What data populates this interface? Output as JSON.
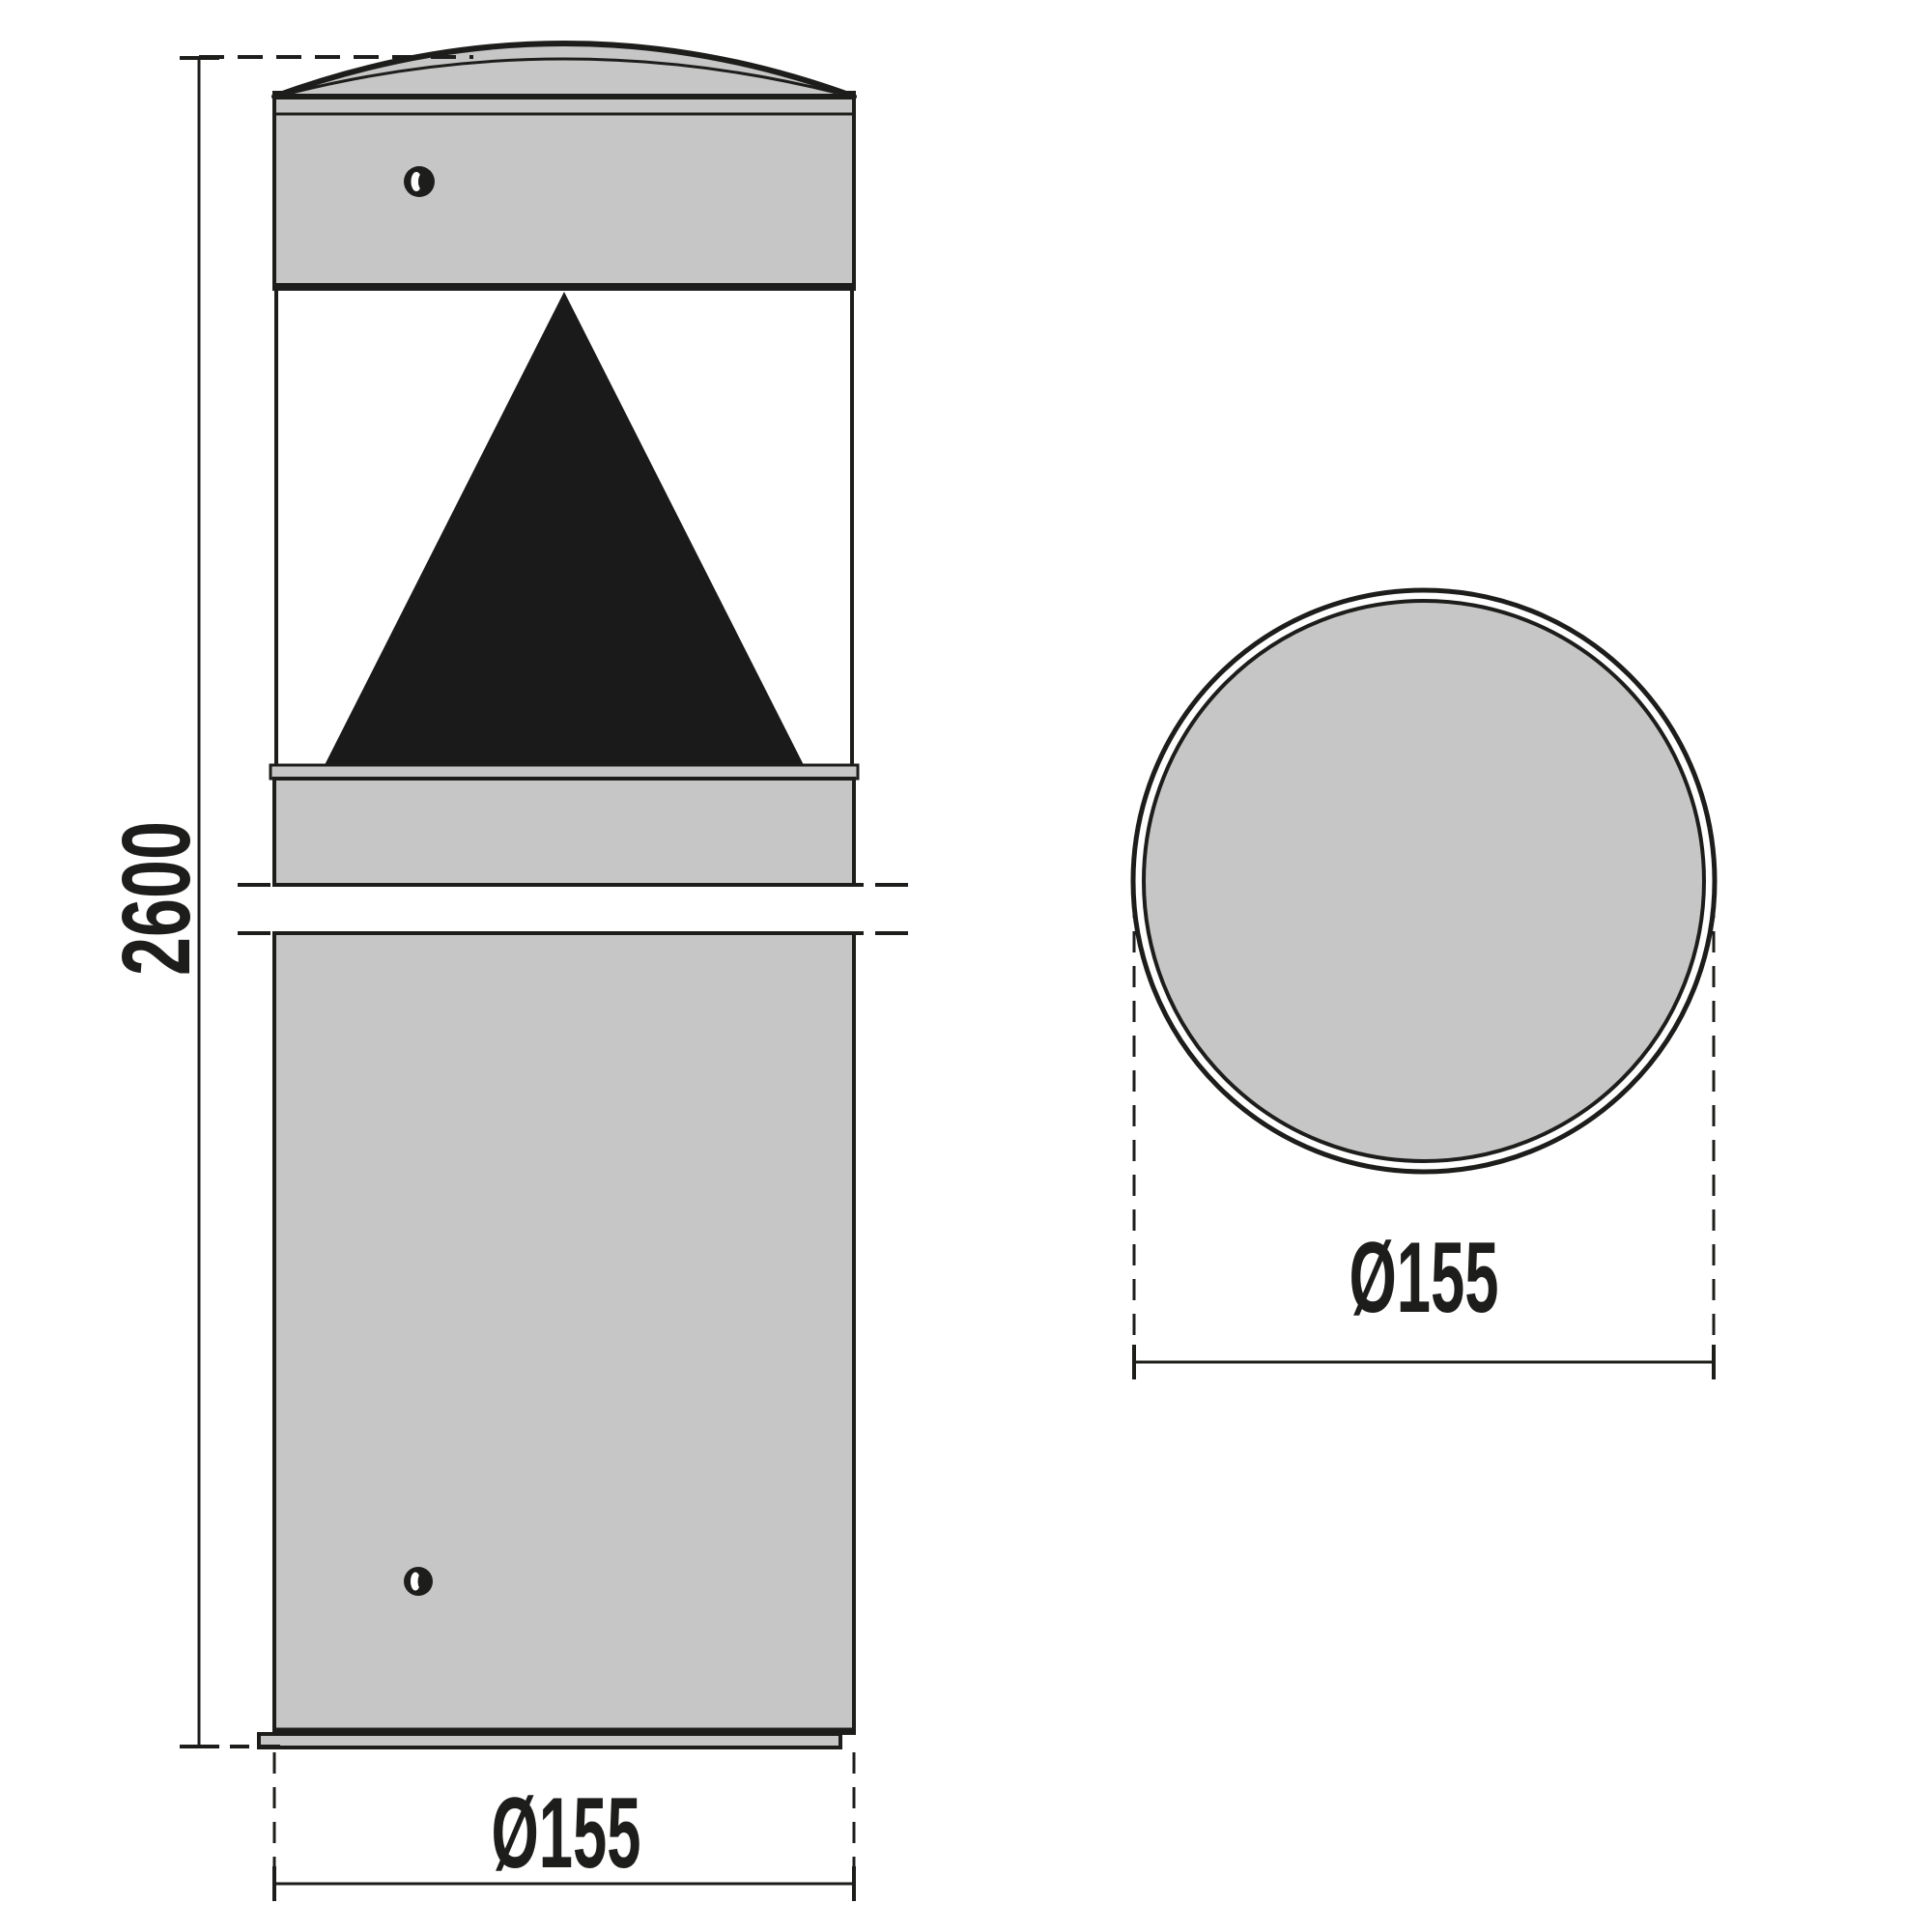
{
  "diagram": {
    "type": "technical-drawing",
    "subject": "cylindrical bollard luminaire, front elevation and top view",
    "colors": {
      "surface": "#c6c6c6",
      "line": "#1d1d1b",
      "aperture": "#1a1a1a",
      "background": "#ffffff"
    },
    "views": {
      "front": {
        "height_dim": "2600",
        "diameter_dim": "Ø155"
      },
      "top": {
        "diameter_dim": "Ø155"
      }
    }
  }
}
